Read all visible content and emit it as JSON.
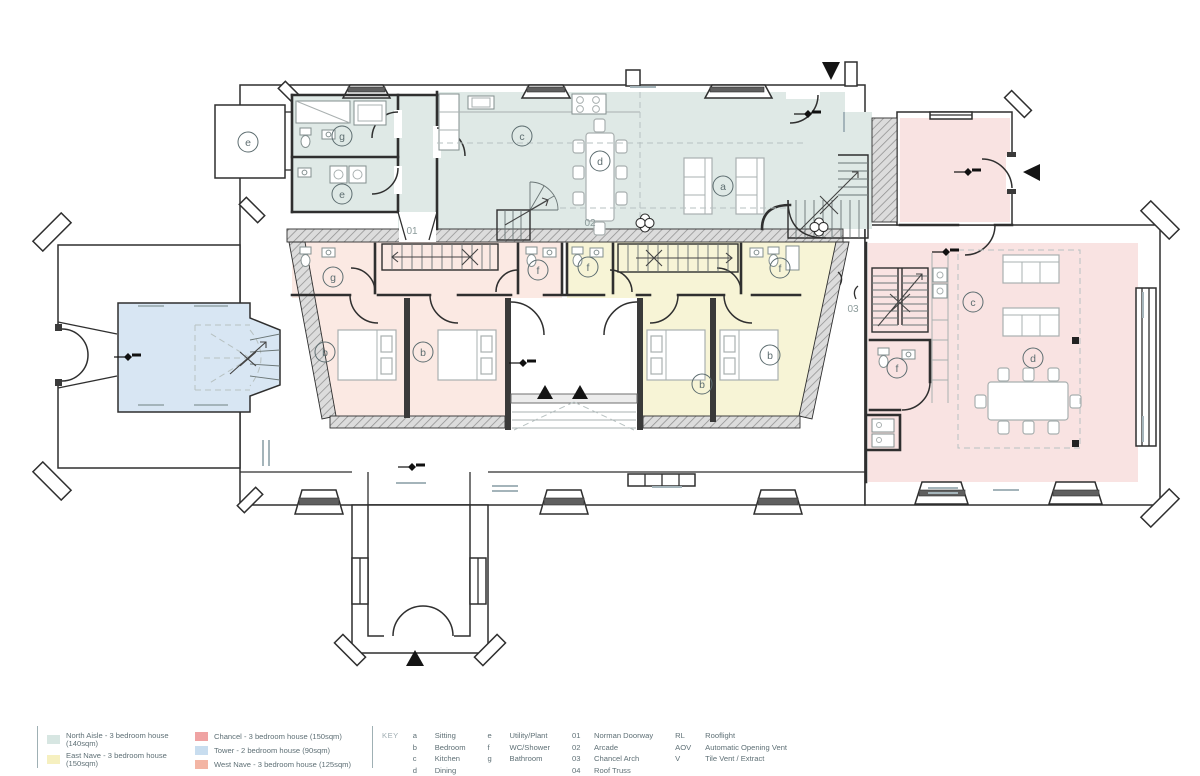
{
  "plan": {
    "colors": {
      "north_aisle": "#dfe9e6",
      "east_nave": "#f7f4d6",
      "west_nave": "#fbe9e3",
      "chancel": "#f9e3e2",
      "tower": "#d8e6f3"
    },
    "markers": {
      "shed_e": "e",
      "annex_g": "g",
      "annex_e": "e",
      "aisle_c": "c",
      "aisle_d": "d",
      "aisle_a": "a",
      "wn_g": "g",
      "wn_f": "f",
      "wn_b1": "b",
      "wn_b2": "b",
      "en_f1": "f",
      "en_f2": "f",
      "en_b1": "b",
      "en_b2": "b",
      "ch_c": "c",
      "ch_d": "d",
      "ch_f": "f"
    },
    "numbers": {
      "norman_doorway": "01",
      "arcade": "02",
      "chancel_arch": "03"
    }
  },
  "legend": {
    "groups": [
      {
        "items": [
          {
            "color": "#d7e6e2",
            "label": "North Aisle - 3 bedroom house (140sqm)"
          },
          {
            "color": "#f6f0c0",
            "label": "East Nave - 3 bedroom house (150sqm)"
          }
        ]
      },
      {
        "items": [
          {
            "color": "#efa3a3",
            "label": "Chancel - 3 bedroom house (150sqm)"
          },
          {
            "color": "#c8ddef",
            "label": "Tower - 2 bedroom house (90sqm)"
          },
          {
            "color": "#f3b5a4",
            "label": "West Nave - 3 bedroom house (125sqm)"
          }
        ]
      }
    ],
    "key_title": "KEY",
    "key_columns": [
      {
        "entries": [
          {
            "code": "a",
            "label": "Sitting"
          },
          {
            "code": "b",
            "label": "Bedroom"
          },
          {
            "code": "c",
            "label": "Kitchen"
          },
          {
            "code": "d",
            "label": "Dining"
          }
        ]
      },
      {
        "entries": [
          {
            "code": "e",
            "label": "Utility/Plant"
          },
          {
            "code": "f",
            "label": "WC/Shower"
          },
          {
            "code": "g",
            "label": "Bathroom"
          }
        ]
      },
      {
        "entries": [
          {
            "code": "01",
            "label": "Norman Doorway"
          },
          {
            "code": "02",
            "label": "Arcade"
          },
          {
            "code": "03",
            "label": "Chancel Arch"
          },
          {
            "code": "04",
            "label": "Roof Truss"
          }
        ]
      },
      {
        "entries": [
          {
            "code": "RL",
            "label": "Rooflight"
          },
          {
            "code": "AOV",
            "label": "Automatic Opening Vent"
          },
          {
            "code": "V",
            "label": "Tile Vent / Extract"
          }
        ]
      }
    ]
  }
}
